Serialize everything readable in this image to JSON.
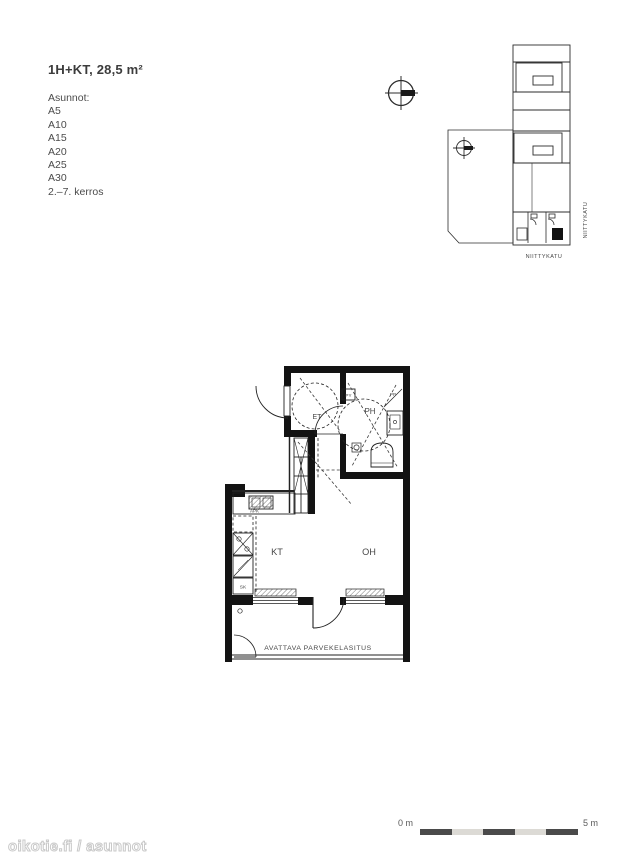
{
  "header": {
    "title": "1H+KT, 28,5 m²"
  },
  "apartments": {
    "label": "Asunnot:",
    "items": [
      "A5",
      "A10",
      "A15",
      "A20",
      "A25",
      "A30"
    ],
    "floors": "2.–7. kerros"
  },
  "site_plan": {
    "street_vertical": "NIITTYKATU",
    "street_horizontal": "NIITTYKATU"
  },
  "floor_plan": {
    "entry_label": "ET",
    "bath_label": "PH",
    "kitchen_label": "KT",
    "living_label": "OH",
    "washer_label": "PY",
    "pp_label": "PP",
    "dishwasher_label": "APK",
    "cleaning_label": "SK",
    "balcony_label": "AVATTAVA PARVEKELASITUS"
  },
  "scale_bar": {
    "start": "0 m",
    "end": "5 m"
  },
  "watermark": {
    "text": "oikotie.fi / asunnot"
  },
  "colors": {
    "plan_line": "#222222",
    "wall_fill": "#131313",
    "scale_dark": "#4a4a4a",
    "scale_light": "#dcdad5"
  }
}
